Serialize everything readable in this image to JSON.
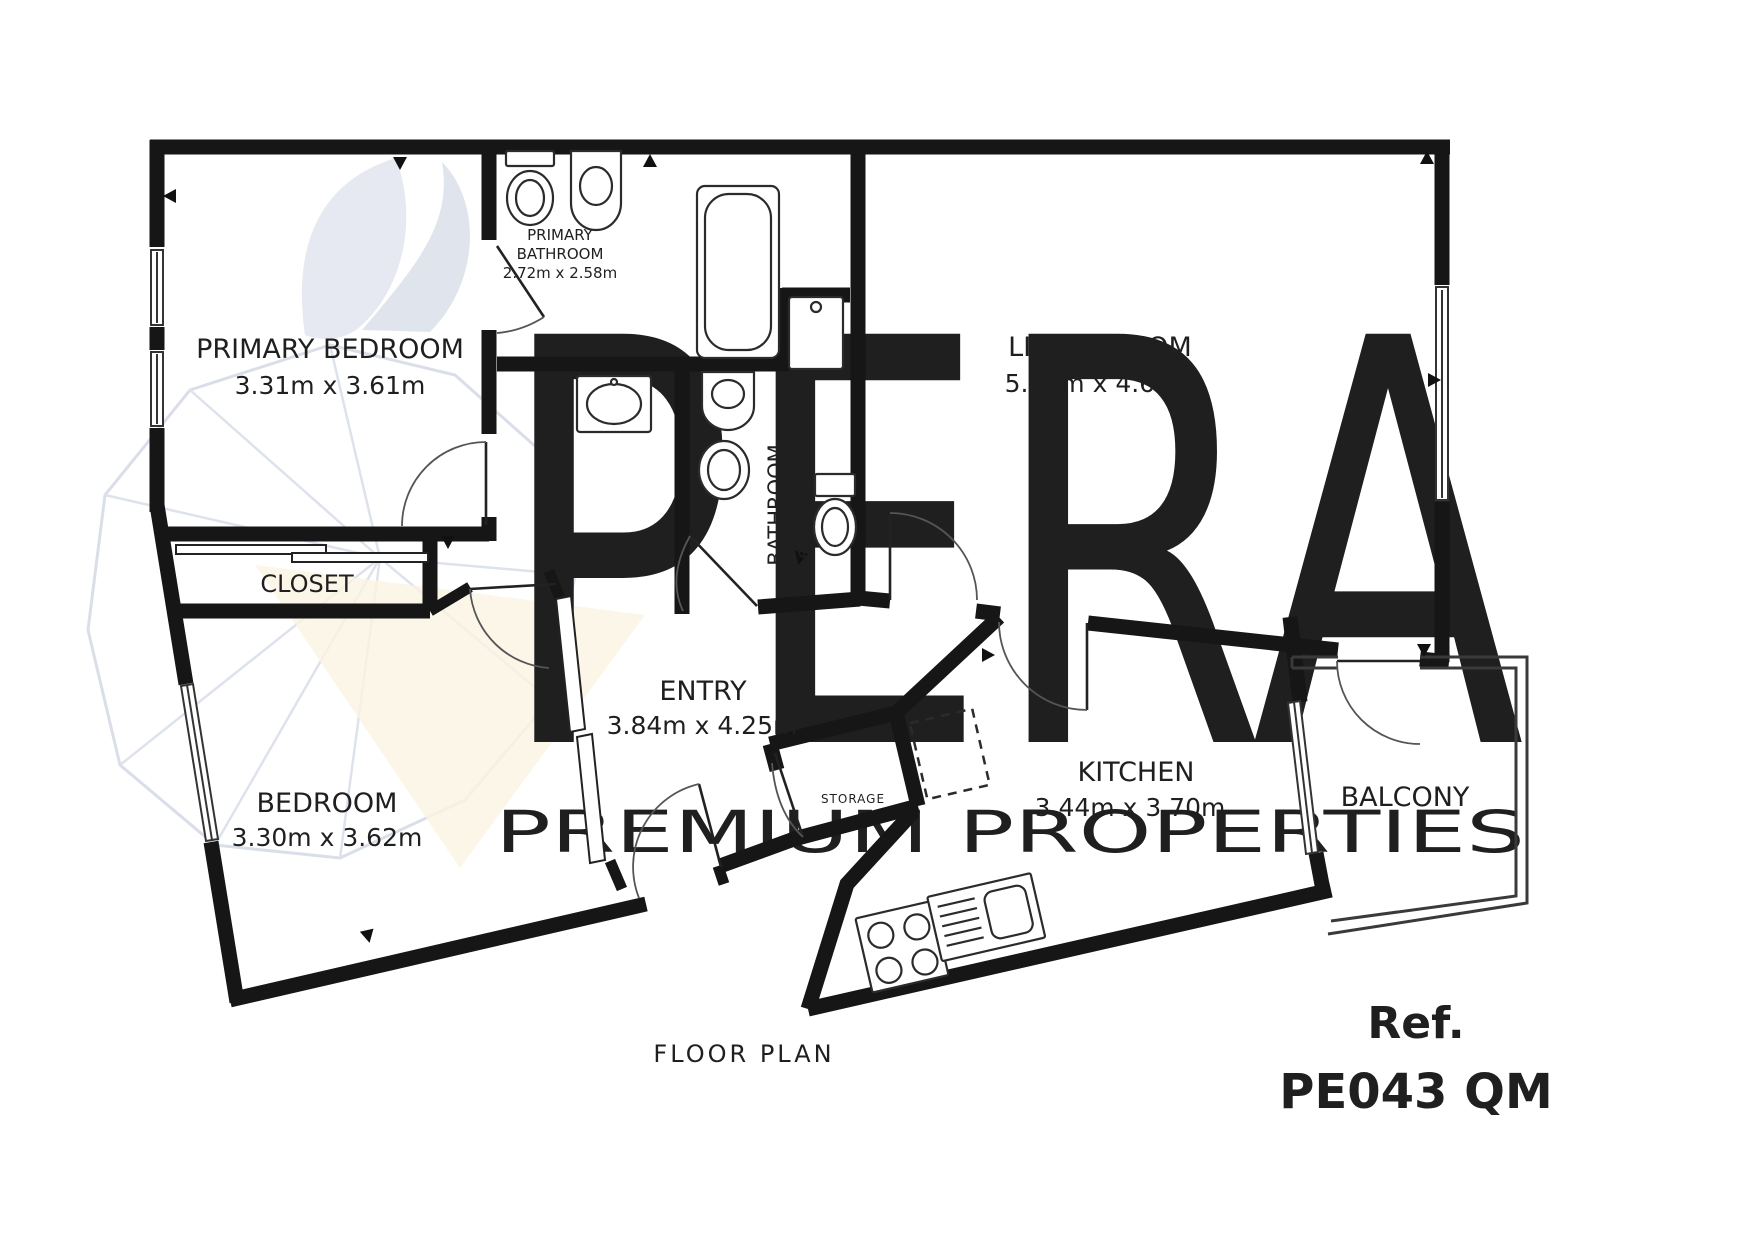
{
  "document": {
    "caption": "FLOOR PLAN"
  },
  "reference": {
    "label": "Ref.",
    "code": "PE043 QM"
  },
  "watermark": {
    "brand": "PERA",
    "tagline": "PREMIUM PROPERTIES",
    "logo": "pear-logo"
  },
  "rooms": {
    "primary_bedroom": {
      "name": "PRIMARY BEDROOM",
      "dims": "3.31m x 3.61m"
    },
    "primary_bathroom": {
      "name_line1": "PRIMARY",
      "name_line2": "BATHROOM",
      "dims": "2.72m x 2.58m"
    },
    "living_room": {
      "name": "LIVING ROOM",
      "dims": "5.25m x 4.62m"
    },
    "bathroom": {
      "name": "BATHROOM",
      "dims": "1.66m x 2.98m"
    },
    "closet": {
      "name": "CLOSET"
    },
    "bedroom": {
      "name": "BEDROOM",
      "dims": "3.30m x 3.62m"
    },
    "entry": {
      "name": "ENTRY",
      "dims": "3.84m x 4.25m"
    },
    "storage": {
      "name": "STORAGE"
    },
    "kitchen": {
      "name": "KITCHEN",
      "dims": "3.44m x 3.70m"
    },
    "balcony": {
      "name": "BALCONY"
    }
  },
  "colors": {
    "walls": "#161616",
    "reference_text": "#263252",
    "watermark_brand": "#e7eaf0",
    "watermark_tagline": "#eceff4",
    "cream_accent": "#faf4e2"
  },
  "fixtures": [
    "toilet",
    "pedestal-sink",
    "bathtub",
    "washing-machine",
    "vanity-sink",
    "wall-sink",
    "toilet-with-cistern",
    "stove-4-burner",
    "kitchen-sink-drainboard",
    "sliding-wardrobe",
    "closet-sliding-doors"
  ]
}
